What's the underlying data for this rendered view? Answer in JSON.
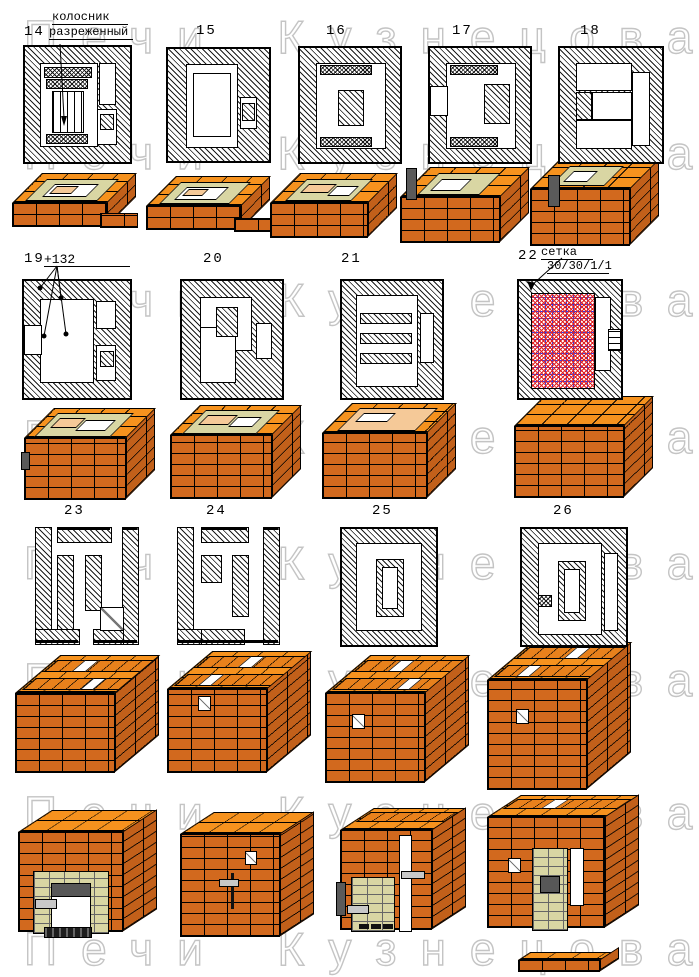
{
  "watermark": {
    "text": "Печи Кузнецова",
    "color": "#c4c4c4"
  },
  "figures": [
    {
      "num": "14",
      "note1": "колосник",
      "note2": "разреженный"
    },
    {
      "num": "15"
    },
    {
      "num": "16"
    },
    {
      "num": "17"
    },
    {
      "num": "18"
    },
    {
      "num": "19",
      "note1": "+132"
    },
    {
      "num": "20"
    },
    {
      "num": "21"
    },
    {
      "num": "22",
      "note1": "сетка",
      "note2": "30/30/1/1"
    },
    {
      "num": "23"
    },
    {
      "num": "24"
    },
    {
      "num": "25"
    },
    {
      "num": "26"
    }
  ],
  "colors": {
    "brick_top": "#f6921e",
    "brick_front": "#d2691e",
    "brick_side": "#c2601a",
    "firebrick": "#d9d6a3",
    "light_brick": "#f5c998",
    "mesh_red": "#e02020",
    "mesh_blue": "#3a3ae6",
    "metal_dark": "#575757",
    "metal_light": "#c8c8c8",
    "watermark_outline": "#c4c4c4"
  }
}
